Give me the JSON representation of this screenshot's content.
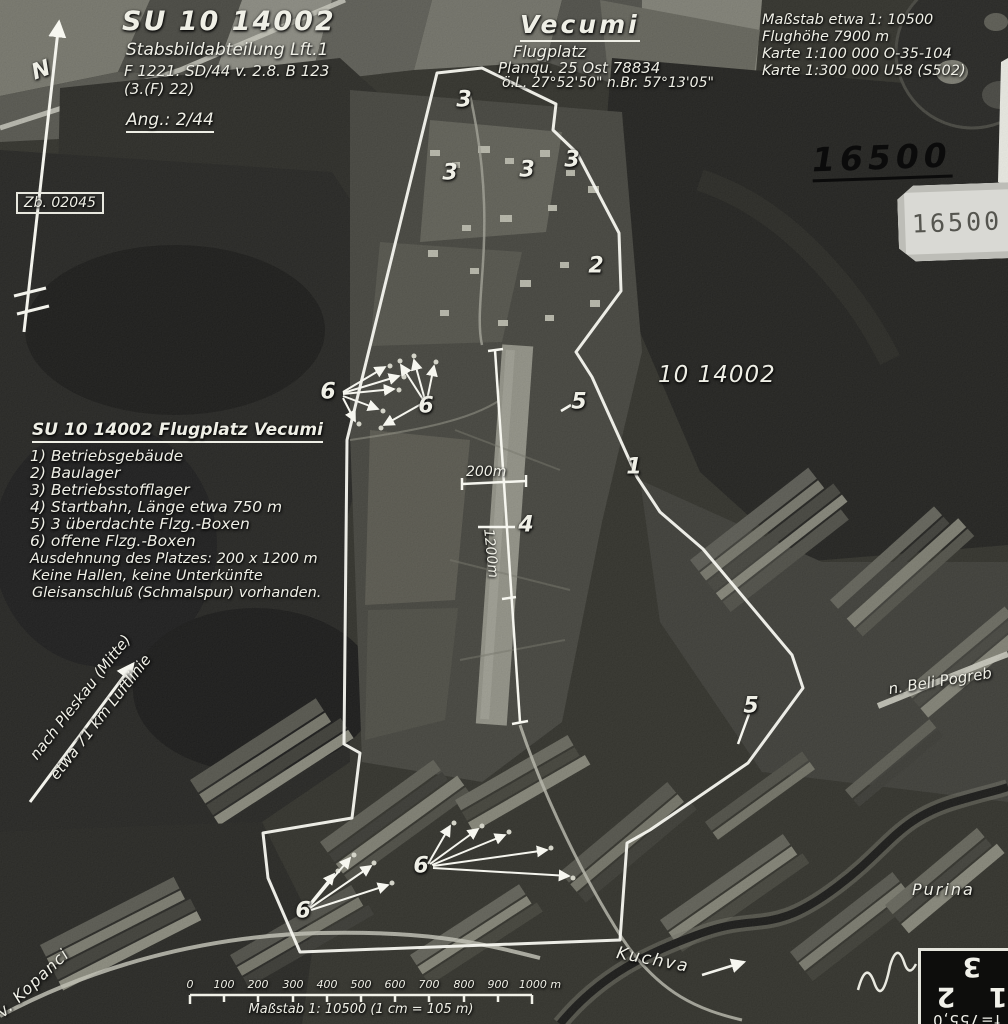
{
  "header": {
    "photo_id": "SU 10 14002",
    "unit": "Stabsbildabteilung Lft.1",
    "mission": "F 1221. SD/44 v. 2.8. B 123",
    "squadron": "(3.(F) 22)",
    "ang": "Ang.: 2/44",
    "zb": "Zb. 02045"
  },
  "title_block": {
    "place": "Vecumi",
    "site_type": "Flugplatz",
    "grid": "Planqu. 25 Ost 78834",
    "coords": "ö.L. 27°52'50\" n.Br. 57°13'05\""
  },
  "info_block": {
    "lines": [
      "Maßstab etwa 1: 10500",
      "Flughöhe   7900 m",
      "Karte 1:100 000  O-35-104",
      "Karte 1:300 000  U58 (S502)"
    ]
  },
  "stamps": {
    "handwritten_number": "16500",
    "label_number": "16500",
    "photo_ref": "10 14002",
    "corner_caption": "f=755,0",
    "corner_digits": "1 2 3"
  },
  "legend": {
    "title": "SU 10 14002  Flugplatz Vecumi",
    "items": [
      "1) Betriebsgebäude",
      "2) Baulager",
      "3) Betriebsstofflager",
      "4) Startbahn, Länge etwa 750 m",
      "5) 3 überdachte Flzg.-Boxen",
      "6) offene Flzg.-Boxen"
    ],
    "notes": [
      "Ausdehnung des Platzes: 200 x 1200 m",
      "Keine Hallen, keine Unterkünfte",
      "Gleisanschluß (Schmalspur) vorhanden."
    ]
  },
  "map_labels": {
    "north": "N",
    "direction_line1": "nach Pleskau (Mitte)",
    "direction_line2": "etwa 71 km Luftlinie",
    "road_ne": "n. Beli Pogreb",
    "village": "Purina",
    "river": "Kuchva",
    "road_sw": "v. Kopanci"
  },
  "dimensions": {
    "width_label": "200m",
    "length_label": "1200m"
  },
  "markers": {
    "labels": [
      "3",
      "3",
      "3",
      "3",
      "2",
      "5",
      "1",
      "4",
      "5",
      "6",
      "6",
      "6",
      "6"
    ]
  },
  "scalebar": {
    "ticks": [
      "0",
      "100",
      "200",
      "300",
      "400",
      "500",
      "600",
      "700",
      "800",
      "900",
      "1000 m"
    ],
    "caption": "Maßstab 1: 10500  (1 cm = 105 m)"
  }
}
